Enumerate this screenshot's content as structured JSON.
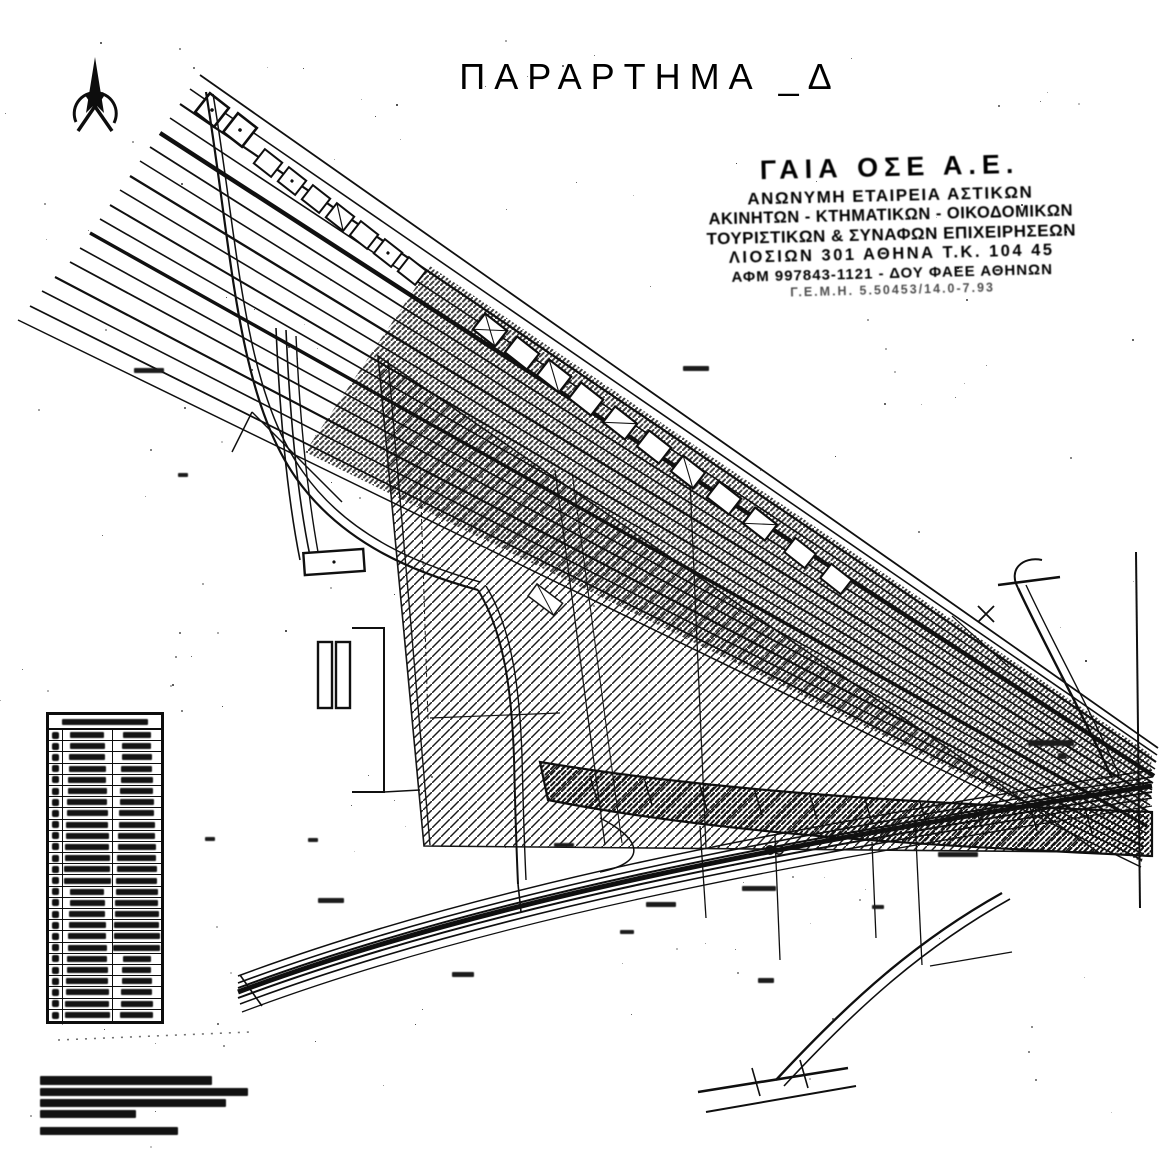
{
  "page": {
    "title": "ΠΑΡΑΡΤΗΜΑ _Δ"
  },
  "stamp": {
    "lines": [
      "ΓΑΙΑ ΟΣΕ Α.Ε.",
      "ΑΝΩΝΥΜΗ ΕΤΑΙΡΕΙΑ ΑΣΤΙΚΩΝ",
      "ΑΚΙΝΗΤΩΝ - ΚΤΗΜΑΤΙΚΩΝ - ΟΙΚΟΔΟΜΙΚΩΝ",
      "ΤΟΥΡΙΣΤΙΚΩΝ & ΣΥΝΑΦΩΝ ΕΠΙΧΕΙΡΗΣΕΩΝ",
      "ΛΙΟΣΙΩΝ 301 ΑΘΗΝΑ Τ.Κ. 104 45",
      "ΑΦΜ 997843-1121 - ΔΟΥ ΦΑΕΕ ΑΘΗΝΩΝ",
      "Γ.Ε.Μ.Η. 5.50453/14.0-7.93"
    ]
  },
  "coordinate_table": {
    "row_count": 26,
    "column_count": 3,
    "legibility": "illegible in scan"
  },
  "footnote": {
    "line_count": 5,
    "legibility": "illegible in scan"
  },
  "map": {
    "compass": "north-arrow",
    "features": [
      "railway-corridor-diagonal",
      "hatched-parcel-triangle",
      "curved-roads-left",
      "bottom-railway-band",
      "branch-road-bottom-right"
    ],
    "colors": {
      "ink": "#111111",
      "paper": "#ffffff"
    }
  }
}
